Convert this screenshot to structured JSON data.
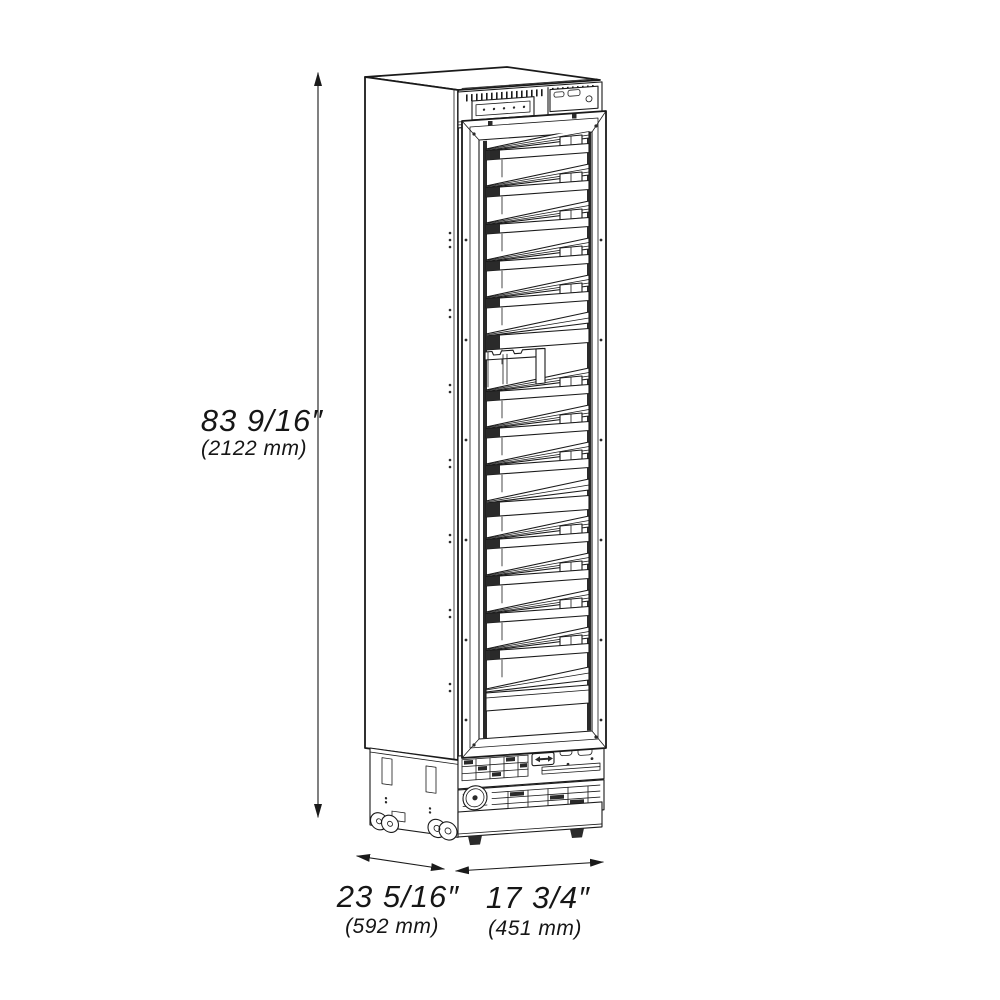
{
  "dimensions": {
    "height": {
      "imperial": "83 9/16″",
      "metric": "(2122 mm)"
    },
    "depth": {
      "imperial": "23 5/16″",
      "metric": "(592 mm)"
    },
    "width": {
      "imperial": "17 3/4″",
      "metric": "(451 mm)"
    }
  },
  "colors": {
    "line": "#1a1a1a",
    "background": "#ffffff"
  },
  "icons": {
    "dimension_arrow": "double-headed-arrow",
    "fan": "circular-fan-grille"
  }
}
